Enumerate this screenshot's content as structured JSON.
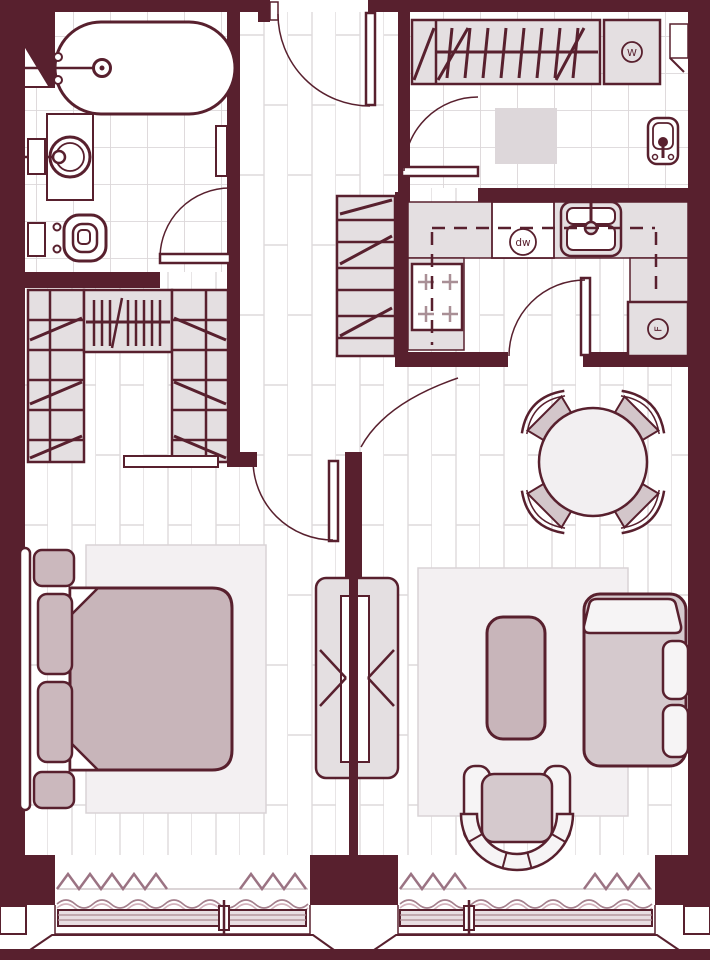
{
  "appliances": {
    "washer": {
      "label": "W"
    },
    "dishwasher": {
      "label": "dw"
    },
    "fridge": {
      "label": "F"
    }
  },
  "palette": {
    "wall": "#58202e",
    "line": "#58202e",
    "furniture_gray": "#e4dfe1",
    "furniture_mauve": "#c8b5ba",
    "rug": "#f3f0f2",
    "floor_line": "#dedadc",
    "curtain_zigzag": "#9b7383",
    "curtain_wave_light": "#d3b3bd"
  }
}
